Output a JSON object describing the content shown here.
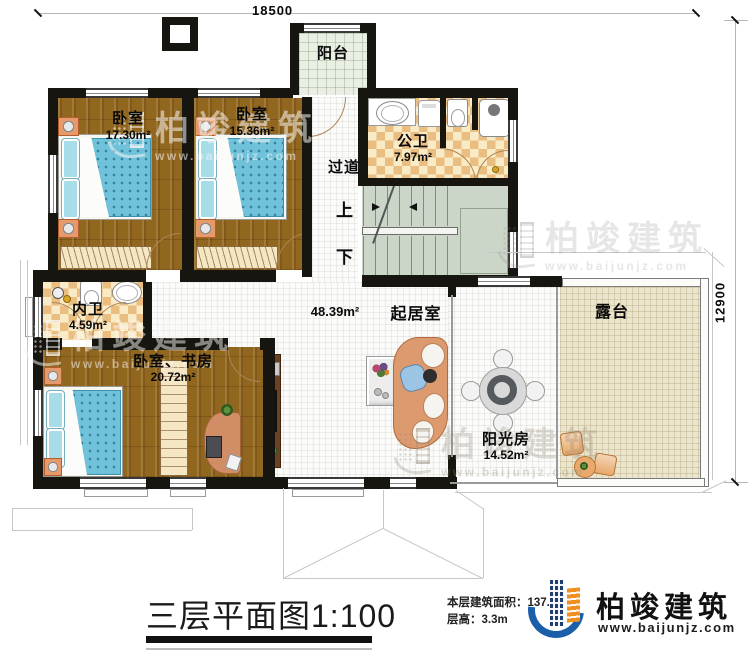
{
  "dimensions": {
    "width": "18500",
    "height": "12900"
  },
  "rooms": {
    "balcony": {
      "name": "阳台"
    },
    "bedroom1": {
      "name": "卧室",
      "area": "17.30m²"
    },
    "bedroom2": {
      "name": "卧室",
      "area": "15.36m²"
    },
    "public_bath": {
      "name": "公卫",
      "area": "7.97m²"
    },
    "corridor": {
      "name": "过道"
    },
    "inner_bath": {
      "name": "内卫",
      "area": "4.59m²"
    },
    "bedroom_study": {
      "name": "卧室、书房",
      "area": "20.72m²"
    },
    "living": {
      "name": "起居室",
      "area": "48.39m²"
    },
    "sunroom": {
      "name": "阳光房",
      "area": "14.52m²"
    },
    "terrace": {
      "name": "露台"
    }
  },
  "stairs": {
    "up": "上",
    "down": "下"
  },
  "title": {
    "text": "三层平面图1:100"
  },
  "info": {
    "floor_area": "本层建筑面积：137.2",
    "floor_height": "层高：3.3m"
  },
  "brand": {
    "name": "柏竣建筑",
    "website": "www.baijunjz.com"
  },
  "watermark": {
    "name": "柏竣建筑",
    "website": "www.baijunjz.com"
  },
  "colors": {
    "wall": "#17150f",
    "wood": "#91661f",
    "tile_accent": "#eabd81",
    "brand_blue": "#1b5fa8",
    "brand_orange": "#f08f1e"
  }
}
